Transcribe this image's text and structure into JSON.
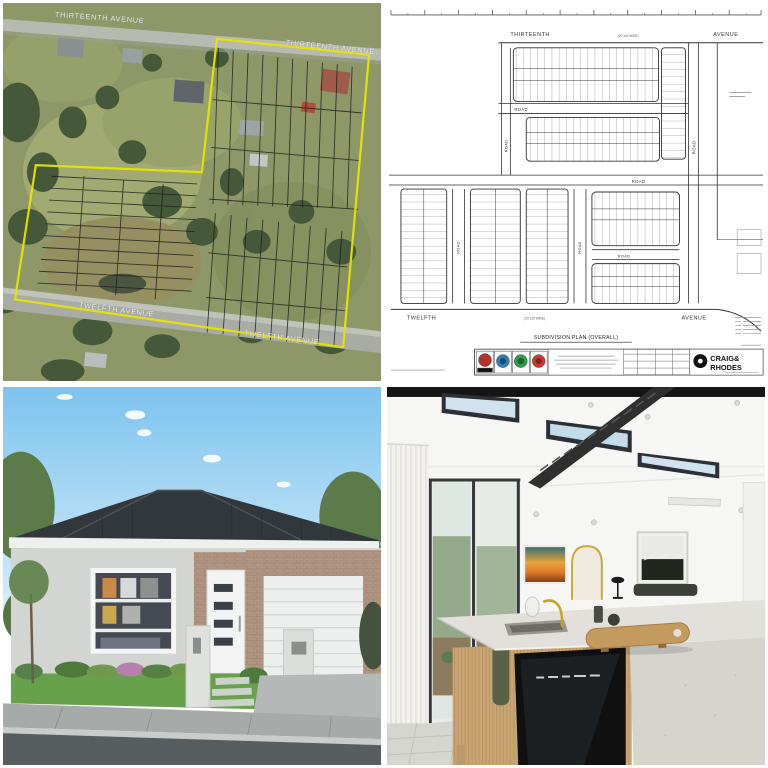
{
  "aerial": {
    "street_labels": {
      "thirteenth_a": "THIRTEENTH AVENUE",
      "thirteenth_b": "THIRTEENTH AVENUE",
      "twelfth_a": "TWELFTH AVENUE",
      "twelfth_b": "TWELFTH AVENUE"
    },
    "boundary_color": "#e8e400"
  },
  "plan": {
    "top_street": {
      "name": "THIRTEENTH",
      "width_note": "(20.115 WIDE)",
      "suffix": "AVENUE"
    },
    "bottom_street": {
      "name": "TWELFTH",
      "width_note": "(20.115 WIDE)",
      "suffix": "AVENUE"
    },
    "road_label": "ROAD",
    "title": "SUBDIVISION PLAN (OVERALL)",
    "surveyor": {
      "name_line1": "CRAIG&",
      "name_line2": "RHODES"
    },
    "stamp_colors": [
      "#b5332d",
      "#2d7fc0",
      "#2f9e4d",
      "#cf3a2e"
    ]
  },
  "house_render": {
    "palette": {
      "roof": "#31373b",
      "wall": "#d2d5d2",
      "lawn": "#67a14b",
      "sky": "#7cc3ee"
    }
  },
  "kitchen_photo": {
    "palette": {
      "brass_accent": "#c9a227",
      "timber": "#c9a574",
      "stone_bench": "#e2e0da",
      "appliance": "#101010"
    }
  }
}
